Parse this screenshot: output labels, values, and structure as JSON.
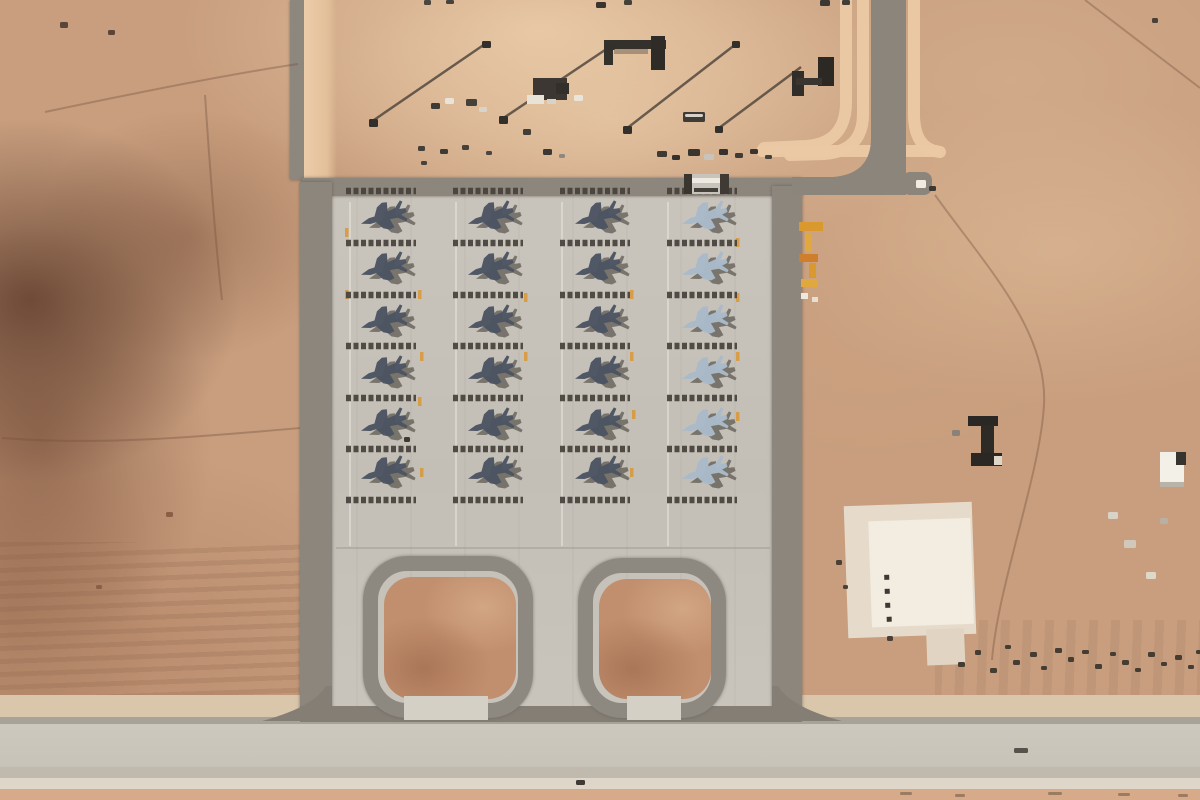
{
  "meta": {
    "subject": "Satellite view of a desert airbase: concrete apron with 24 fighter jets parked in four columns of six, blast-deflector bars between rows, twin loop taxiways leading to a runway, access roads and small structures in surrounding sand",
    "width": 1200,
    "height": 800
  },
  "palette": {
    "sand": "#c89e7e",
    "apron": "#c7c3bb",
    "strip_dark": "#8c857c",
    "flare_dark": "#847e75",
    "island": "#c28f6e",
    "berm": "#ecc9a5",
    "jet_dark": "#4c5462",
    "jet_light": "#a9bac9",
    "jet_shadow": "#39342d",
    "blast_bar": "#46423b",
    "marking_yellow": "#d8993c",
    "fence_line": "#4a4239",
    "track": "rgba(115,82,60,0.38)",
    "guide_light": "rgba(240,237,230,0.45)",
    "guide_gray": "rgba(150,145,136,0.4)"
  },
  "aircraft": {
    "count": 24,
    "rows_per_column": 6,
    "heading_deg": 163,
    "row_ys": [
      217,
      268,
      321,
      372,
      424,
      472
    ],
    "shadow_offset": [
      8,
      4
    ],
    "columns": [
      {
        "cx": 383,
        "fill": "dark"
      },
      {
        "cx": 490,
        "fill": "dark"
      },
      {
        "cx": 597,
        "fill": "dark"
      },
      {
        "cx": 704,
        "fill": "light"
      }
    ]
  },
  "blast_bars": {
    "ys": [
      191,
      243,
      295,
      346,
      398,
      449,
      500
    ],
    "left": 37,
    "right": 33,
    "stroke_width": 6.5,
    "dash": "5 2.5"
  },
  "apron_markings": {
    "guide_vertical_x": [
      350,
      456,
      562,
      668
    ],
    "guide_vertical_y": [
      202,
      546
    ],
    "guide_horizontal": [
      336,
      548,
      770
    ],
    "yellow_dashes": [
      [
        345,
        228
      ],
      [
        345,
        290
      ],
      [
        418,
        290
      ],
      [
        420,
        352
      ],
      [
        418,
        397
      ],
      [
        420,
        468
      ],
      [
        524,
        293
      ],
      [
        524,
        352
      ],
      [
        630,
        290
      ],
      [
        630,
        352
      ],
      [
        632,
        410
      ],
      [
        630,
        468
      ],
      [
        736,
        238
      ],
      [
        736,
        293
      ],
      [
        736,
        352
      ],
      [
        736,
        412
      ]
    ]
  },
  "roads": {
    "dark_path": "M871,0 L871,138 Q871,174 833,177 L792,177 L792,195 L906,195 L906,0 Z",
    "dark_stub": [
      902,
      172,
      30,
      23
    ],
    "berm_paths": [
      "M846,-8 L846,102 Q846,143 806,146 L764,148",
      "M863,-8 L863,114 Q863,151 824,154 L790,155",
      "M914,-8 L914,114 Q914,149 940,152",
      "M762,151 L936,151"
    ],
    "corner_flares": [
      "M332,686 L332,721 L262,721 C292,713 316,702 326,686 Z",
      "M772,686 L772,721 L842,721 C812,713 788,702 778,686 Z"
    ]
  },
  "fence_lines": [
    [
      371,
      122,
      485,
      44
    ],
    [
      502,
      119,
      611,
      46
    ],
    [
      626,
      129,
      736,
      44
    ],
    [
      719,
      128,
      801,
      67
    ]
  ],
  "track_paths": [
    "M935,195 C985,265 1048,330 1044,405 C1040,475 998,585 992,660",
    "M1085,0 L1200,88",
    "M45,112 C140,92 230,74 298,64",
    "M2,438 C100,446 210,436 300,428",
    "M205,95 C210,170 215,240 222,300"
  ],
  "structures": [
    {
      "name": "shelter-frame-c",
      "rects": [
        [
          604,
          40,
          62,
          9,
          "#34302b"
        ],
        [
          604,
          47,
          9,
          18,
          "#34302b"
        ],
        [
          651,
          36,
          14,
          34,
          "#2f2b27"
        ],
        [
          614,
          49,
          34,
          5,
          "rgba(60,55,48,0.35)"
        ]
      ]
    },
    {
      "name": "shelter-frame-h",
      "rects": [
        [
          792,
          71,
          12,
          25,
          "#312d29"
        ],
        [
          818,
          57,
          16,
          29,
          "#2c2925"
        ],
        [
          796,
          78,
          26,
          7,
          "#3a352f"
        ]
      ]
    },
    {
      "name": "vehicle-cluster",
      "rects": [
        [
          533,
          78,
          34,
          22,
          "#3c3732"
        ],
        [
          527,
          95,
          17,
          9,
          "#e9e3d7"
        ],
        [
          556,
          83,
          13,
          11,
          "#332f2a"
        ],
        [
          547,
          99,
          9,
          5,
          "#d9d3c7"
        ]
      ]
    },
    {
      "name": "apron-top-frame",
      "rects": [
        [
          684,
          174,
          44,
          20,
          "#c9c4bb"
        ],
        [
          684,
          174,
          8,
          20,
          "#3a362f"
        ],
        [
          720,
          174,
          9,
          20,
          "#3f3b34"
        ],
        [
          692,
          178,
          28,
          5,
          "#efeae1"
        ],
        [
          694,
          188,
          24,
          4,
          "#44403a"
        ]
      ]
    },
    {
      "name": "building-i-shape",
      "rects": [
        [
          968,
          416,
          30,
          10,
          "#2b2724"
        ],
        [
          981,
          425,
          13,
          32,
          "#2e2a26"
        ],
        [
          971,
          453,
          31,
          13,
          "#2b2724"
        ],
        [
          994,
          456,
          8,
          9,
          "#ddd6c9"
        ]
      ]
    },
    {
      "name": "building-white",
      "rects": [
        [
          1160,
          452,
          24,
          34,
          "#f3f0e8"
        ],
        [
          1176,
          452,
          10,
          13,
          "#37332e"
        ],
        [
          1160,
          482,
          24,
          5,
          "#b9b2a6"
        ]
      ]
    },
    {
      "name": "concrete-pad",
      "rotate": [
        -2,
        910,
        570
      ],
      "rects": [
        [
          846,
          504,
          128,
          132,
          "#e6dbcb"
        ],
        [
          870,
          520,
          102,
          106,
          "#f3ece0"
        ],
        [
          924,
          630,
          38,
          36,
          "#e2d4c2"
        ],
        [
          884,
          574,
          5,
          5,
          "#3e3933"
        ],
        [
          884,
          588,
          5,
          5,
          "#3e3933"
        ],
        [
          884,
          602,
          5,
          5,
          "#3e3933"
        ],
        [
          885,
          616,
          5,
          5,
          "#3e3933"
        ]
      ]
    },
    {
      "name": "equipment-yellow",
      "rects": [
        [
          799,
          222,
          24,
          9,
          "#d9992f"
        ],
        [
          805,
          233,
          7,
          19,
          "#e0a83f"
        ],
        [
          799,
          254,
          19,
          8,
          "#cf7e2c"
        ],
        [
          809,
          263,
          7,
          15,
          "#d9992f"
        ],
        [
          801,
          279,
          17,
          8,
          "#e0a83f"
        ],
        [
          801,
          293,
          7,
          6,
          "#eee8dd"
        ],
        [
          812,
          297,
          6,
          5,
          "#e6e0d4"
        ]
      ]
    }
  ],
  "scatter": [
    [
      424,
      0,
      7,
      5,
      "#4a4640"
    ],
    [
      446,
      0,
      8,
      4,
      "#46423c"
    ],
    [
      596,
      2,
      10,
      6,
      "#3a362f"
    ],
    [
      624,
      0,
      8,
      5,
      "#44403a"
    ],
    [
      820,
      0,
      10,
      6,
      "#3c3832"
    ],
    [
      842,
      0,
      8,
      5,
      "#413d37"
    ],
    [
      60,
      22,
      8,
      6,
      "#5a4638"
    ],
    [
      108,
      30,
      7,
      5,
      "#5a4638"
    ],
    [
      369,
      119,
      9,
      8,
      "#332f2a"
    ],
    [
      482,
      41,
      9,
      7,
      "#332f2a"
    ],
    [
      499,
      116,
      9,
      8,
      "#332f2a"
    ],
    [
      607,
      43,
      8,
      7,
      "#332f2a"
    ],
    [
      623,
      126,
      9,
      8,
      "#332f2a"
    ],
    [
      732,
      41,
      8,
      7,
      "#332f2a"
    ],
    [
      715,
      126,
      8,
      7,
      "#332f2a"
    ],
    [
      445,
      98,
      9,
      6,
      "#e9e3d8"
    ],
    [
      431,
      103,
      9,
      6,
      "#3e3a35"
    ],
    [
      466,
      99,
      11,
      7,
      "#44403a"
    ],
    [
      479,
      107,
      8,
      5,
      "#d9d3c9"
    ],
    [
      574,
      95,
      9,
      6,
      "#eae4da"
    ],
    [
      523,
      129,
      8,
      6,
      "#413d37"
    ],
    [
      418,
      146,
      7,
      5,
      "#43403a"
    ],
    [
      440,
      149,
      8,
      5,
      "#3e3a35"
    ],
    [
      462,
      145,
      7,
      5,
      "#45413b"
    ],
    [
      486,
      151,
      6,
      4,
      "#4a4640"
    ],
    [
      421,
      161,
      6,
      4,
      "#46423b"
    ],
    [
      543,
      149,
      9,
      6,
      "#3c3833"
    ],
    [
      559,
      154,
      6,
      4,
      "#8d8880"
    ],
    [
      683,
      112,
      22,
      10,
      "#3f3b36"
    ],
    [
      685,
      114,
      18,
      3,
      "#d8d2c8"
    ],
    [
      657,
      151,
      10,
      6,
      "#3e3a34"
    ],
    [
      672,
      155,
      8,
      5,
      "#35312c"
    ],
    [
      688,
      149,
      12,
      7,
      "#3a362f"
    ],
    [
      704,
      154,
      10,
      6,
      "#c9c4bb"
    ],
    [
      719,
      149,
      9,
      6,
      "#35312c"
    ],
    [
      735,
      153,
      8,
      5,
      "#3f3b35"
    ],
    [
      750,
      149,
      8,
      5,
      "#38342e"
    ],
    [
      765,
      155,
      7,
      4,
      "#45413b"
    ],
    [
      916,
      180,
      10,
      8,
      "#f0ebe2"
    ],
    [
      929,
      186,
      7,
      5,
      "#3b3732"
    ],
    [
      1152,
      18,
      6,
      5,
      "#4a4038"
    ],
    [
      952,
      430,
      8,
      6,
      "#8a8278"
    ],
    [
      1108,
      512,
      10,
      7,
      "#d9d2c6"
    ],
    [
      1124,
      540,
      12,
      8,
      "#cfc8bb"
    ],
    [
      1146,
      572,
      10,
      7,
      "#ded7ca"
    ],
    [
      1160,
      518,
      8,
      6,
      "#b8b0a3"
    ],
    [
      836,
      560,
      6,
      5,
      "#4a4036"
    ],
    [
      843,
      585,
      5,
      4,
      "#4a4036"
    ],
    [
      887,
      636,
      6,
      5,
      "#4a4036"
    ],
    [
      958,
      662,
      7,
      5,
      "#463d32"
    ],
    [
      975,
      650,
      6,
      5,
      "#463d32"
    ],
    [
      990,
      668,
      7,
      5,
      "#463d32"
    ],
    [
      1005,
      645,
      6,
      4,
      "#463d32"
    ],
    [
      1013,
      660,
      7,
      5,
      "#463d32"
    ],
    [
      1030,
      652,
      7,
      5,
      "#463d32"
    ],
    [
      1041,
      666,
      6,
      4,
      "#463d32"
    ],
    [
      1055,
      648,
      7,
      5,
      "#463d32"
    ],
    [
      1068,
      657,
      6,
      5,
      "#463d32"
    ],
    [
      1082,
      650,
      7,
      4,
      "#463d32"
    ],
    [
      1095,
      664,
      7,
      5,
      "#463d32"
    ],
    [
      1110,
      652,
      6,
      4,
      "#463d32"
    ],
    [
      1122,
      660,
      7,
      5,
      "#463d32"
    ],
    [
      1135,
      668,
      6,
      4,
      "#463d32"
    ],
    [
      1148,
      652,
      7,
      5,
      "#463d32"
    ],
    [
      1161,
      662,
      6,
      4,
      "#463d32"
    ],
    [
      1175,
      655,
      7,
      5,
      "#463d32"
    ],
    [
      1188,
      665,
      6,
      4,
      "#463d32"
    ],
    [
      1196,
      650,
      5,
      4,
      "#463d32"
    ],
    [
      1014,
      748,
      14,
      5,
      "#57524b"
    ],
    [
      576,
      780,
      9,
      5,
      "#3f3a34"
    ],
    [
      404,
      437,
      6,
      5,
      "#3d3934"
    ],
    [
      900,
      792,
      12,
      3,
      "rgba(95,75,58,0.5)"
    ],
    [
      955,
      794,
      10,
      3,
      "rgba(95,75,58,0.5)"
    ],
    [
      1048,
      792,
      14,
      3,
      "rgba(95,75,58,0.5)"
    ],
    [
      1118,
      793,
      12,
      3,
      "rgba(95,75,58,0.5)"
    ],
    [
      1178,
      794,
      10,
      3,
      "rgba(95,75,58,0.5)"
    ],
    [
      166,
      512,
      7,
      5,
      "#8a5f46"
    ],
    [
      96,
      585,
      6,
      4,
      "#8a5f46"
    ]
  ]
}
